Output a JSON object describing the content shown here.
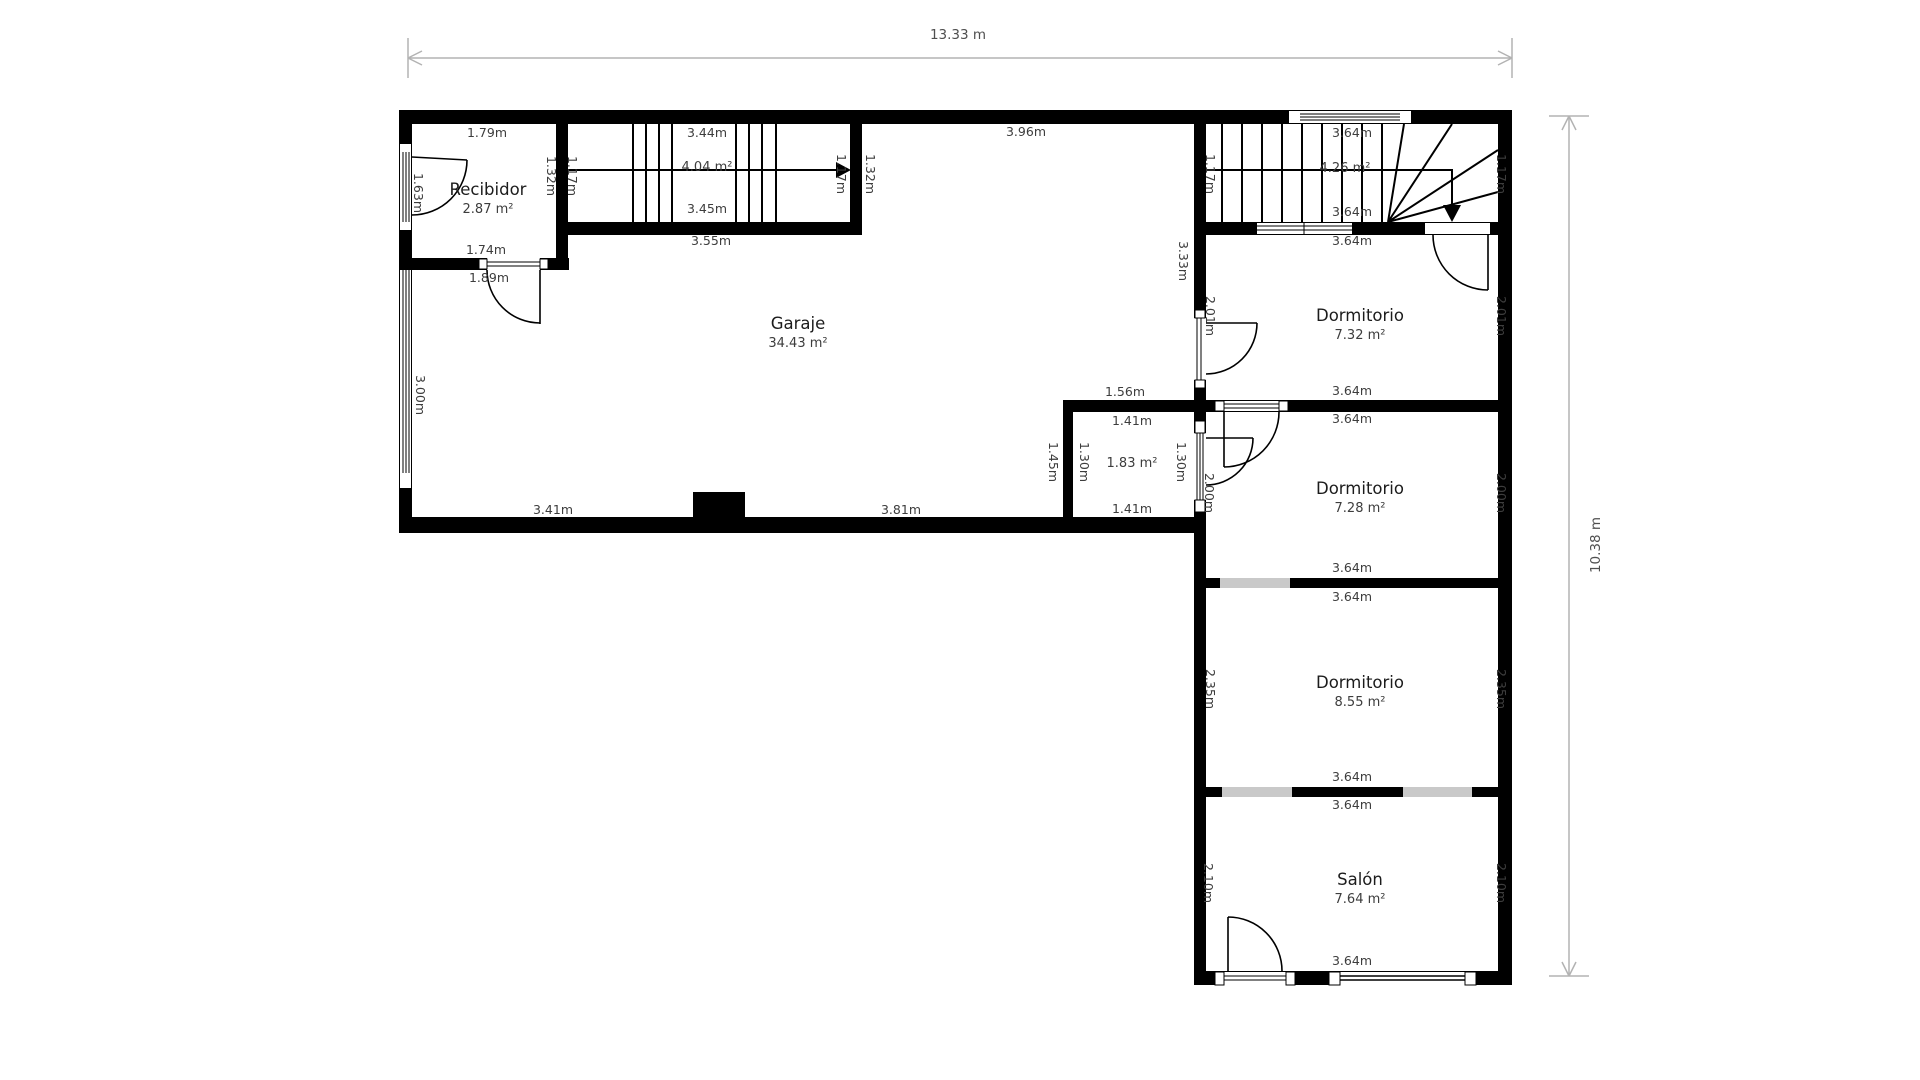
{
  "plan": {
    "overall": {
      "width_label": "13.33 m",
      "height_label": "10.38 m"
    },
    "rooms": {
      "recibidor": {
        "name": "Recibidor",
        "area": "2.87 m²"
      },
      "garaje": {
        "name": "Garaje",
        "area": "34.43 m²"
      },
      "stairs_left": {
        "area": "4.04 m²"
      },
      "stairs_right": {
        "area": "4.26 m²"
      },
      "trastero": {
        "area": "1.83 m²"
      },
      "dormitorio_1": {
        "name": "Dormitorio",
        "area": "7.32 m²"
      },
      "dormitorio_2": {
        "name": "Dormitorio",
        "area": "7.28 m²"
      },
      "dormitorio_3": {
        "name": "Dormitorio",
        "area": "8.55 m²"
      },
      "salon": {
        "name": "Salón",
        "area": "7.64 m²"
      }
    },
    "dims": {
      "d179": "1.79m",
      "d163": "1.63m",
      "d132": "1.32m",
      "d117": "1.17m",
      "d344": "3.44m",
      "d345": "3.45m",
      "d355": "3.55m",
      "d174": "1.74m",
      "d189": "1.89m",
      "d396": "3.96m",
      "d300": "3.00m",
      "d333": "3.33m",
      "d341": "3.41m",
      "d381": "3.81m",
      "d156": "1.56m",
      "d141": "1.41m",
      "d145": "1.45m",
      "d130": "1.30m",
      "d200": "2.00m",
      "d201": "2.01m",
      "d235": "2.35m",
      "d210": "2.10m",
      "d364": "3.64m"
    },
    "colors": {
      "wall": "#000000",
      "window_gray": "#c9c9c9",
      "dimension_line": "#b3b3b3"
    }
  }
}
